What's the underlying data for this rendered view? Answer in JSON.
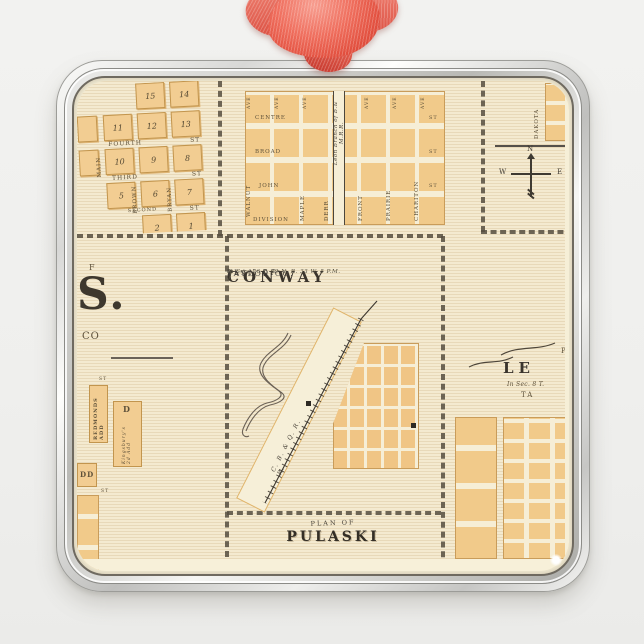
{
  "colors": {
    "background": "#f0f0ee",
    "frame_silver_light": "#fafaf8",
    "frame_silver_dark": "#8e8e8a",
    "map_paper": "#f4ead0",
    "map_margin": "#f7f0d9",
    "block_orange": "#f1ca8a",
    "ink": "#45403a",
    "section_line": "#564e40",
    "ribbon_red": "#e85c4e",
    "ribbon_red_dark": "#cc4237",
    "ribbon_red_light": "#f59a8e"
  },
  "map": {
    "panels": {
      "northwest_town": {
        "block_numbers": [
          "15",
          "14",
          "11",
          "12",
          "13",
          "10",
          "9",
          "8",
          "5",
          "6",
          "7",
          "2",
          "1"
        ],
        "streets_horizontal": [
          "FOURTH",
          "THIRD",
          "SECOND"
        ],
        "streets_vertical": [
          "MAIN",
          "BROWN",
          "BRYAN"
        ],
        "st_label": "ST"
      },
      "north_town": {
        "streets_horizontal": [
          "CENTRE",
          "BROAD",
          "JOHN",
          "DIVISION"
        ],
        "streets_vertical_west": [
          "WALNUT",
          "MAPLE",
          "DERR"
        ],
        "streets_vertical_east": [
          "FRONT",
          "PRAIRIE",
          "CHARITON"
        ],
        "railroad_label": "Leon Branch of B.& M.R.R.",
        "ave_label": "AVE",
        "st_label": "ST"
      },
      "northeast_town": {
        "street_vertical": "DAKOTA"
      },
      "compass": {
        "north": "N",
        "west": "W",
        "east": "E"
      },
      "west_town": {
        "plan_fragment": "F",
        "title_fragment": "S.",
        "county_fragment": "CO",
        "addition_1": "REDMONDS ADD",
        "block_d": "D",
        "addition_2": "Kingsbury's 2d Add",
        "block_dd": "DD",
        "st_label": "ST"
      },
      "conway": {
        "plan_of": "PLAN OF",
        "title": "CONWAY",
        "flourish_left": "(",
        "flourish_right": ")",
        "subtitle": "In Sec. 26 T. 69 N. R. 33 W. 5 P.M.",
        "county": "TAYLOR CO.",
        "railroad_label": "C. B. & Q. R. R."
      },
      "pulaski": {
        "plan_of": "PLAN OF",
        "title": "PULASKI"
      },
      "lenox": {
        "plan_fragment": "P",
        "title_fragment": "LE",
        "subtitle_fragment": "In Sec. 8 T.",
        "county_fragment": "TA"
      }
    }
  }
}
